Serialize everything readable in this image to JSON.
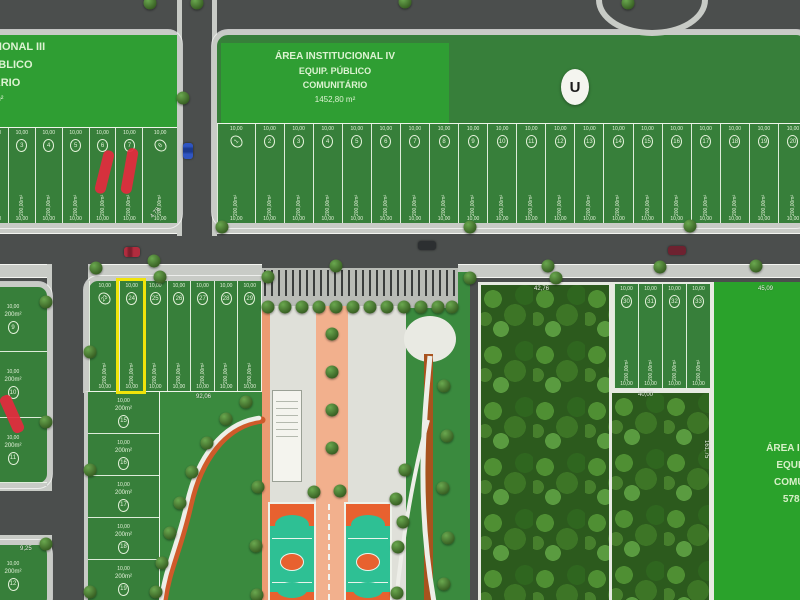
{
  "areas": {
    "iii": {
      "line1": "UCIONAL III",
      "line2": "PÚBLICO",
      "line3": "ITÁRIO",
      "line4": "46 m²"
    },
    "iv": {
      "line1": "ÁREA INSTITUCIONAL IV",
      "line2": "EQUIP. PÚBLICO",
      "line3": "COMUNITÁRIO",
      "line4": "1452,80 m²"
    },
    "v": {
      "line1": "ÁREA INSTITU",
      "line2": "EQUIP. PÚ",
      "line3": "COMUNITÁ",
      "line4": "5789,75"
    }
  },
  "badge_u": "U",
  "dims": {
    "ten": "10,00",
    "twenty": "20,00",
    "forty": "40,00",
    "d4276": "42,76",
    "d4509": "45,09",
    "d16175": "161,75",
    "d478": "4,78",
    "d925": "9,25",
    "d9206": "92,06"
  },
  "lot_area": "200,00m²",
  "lot_area_small": "200m²",
  "lots": {
    "top_left": [
      {
        "n": "2"
      },
      {
        "n": "3"
      },
      {
        "n": "4"
      },
      {
        "n": "5"
      },
      {
        "n": "6"
      },
      {
        "n": "7"
      },
      {
        "n": "8",
        "corner": true
      }
    ],
    "top_strip": [
      {
        "n": "1",
        "corner": true
      },
      {
        "n": "2"
      },
      {
        "n": "3"
      },
      {
        "n": "4"
      },
      {
        "n": "5"
      },
      {
        "n": "6"
      },
      {
        "n": "7"
      },
      {
        "n": "8"
      },
      {
        "n": "9"
      },
      {
        "n": "10"
      },
      {
        "n": "11"
      },
      {
        "n": "12"
      },
      {
        "n": "13"
      },
      {
        "n": "14"
      },
      {
        "n": "15"
      },
      {
        "n": "16"
      },
      {
        "n": "17"
      },
      {
        "n": "18"
      },
      {
        "n": "19"
      },
      {
        "n": "20"
      }
    ],
    "mid": [
      {
        "n": "23",
        "corner": true
      },
      {
        "n": "24",
        "highlight": true
      },
      {
        "n": "25"
      },
      {
        "n": "26"
      },
      {
        "n": "27"
      },
      {
        "n": "28"
      },
      {
        "n": "29"
      }
    ],
    "left_col": [
      {
        "n": "15"
      },
      {
        "n": "16"
      },
      {
        "n": "17"
      },
      {
        "n": "18"
      },
      {
        "n": "19"
      }
    ],
    "right_block": [
      {
        "n": "30"
      },
      {
        "n": "31"
      },
      {
        "n": "32"
      },
      {
        "n": "33"
      }
    ],
    "bl1": [
      {
        "n": "9"
      },
      {
        "n": "10"
      },
      {
        "n": "11"
      }
    ],
    "bl2": [
      {
        "n": "12"
      }
    ]
  },
  "colors": {
    "highlight": "#f0e40a",
    "sold": "#e22b3d",
    "court_teal": "#2ec094",
    "court_orange": "#e8612f",
    "path_orange": "#cf5a2a",
    "institutional_green": "#2f9e33",
    "lot_green": "#377f3a"
  }
}
